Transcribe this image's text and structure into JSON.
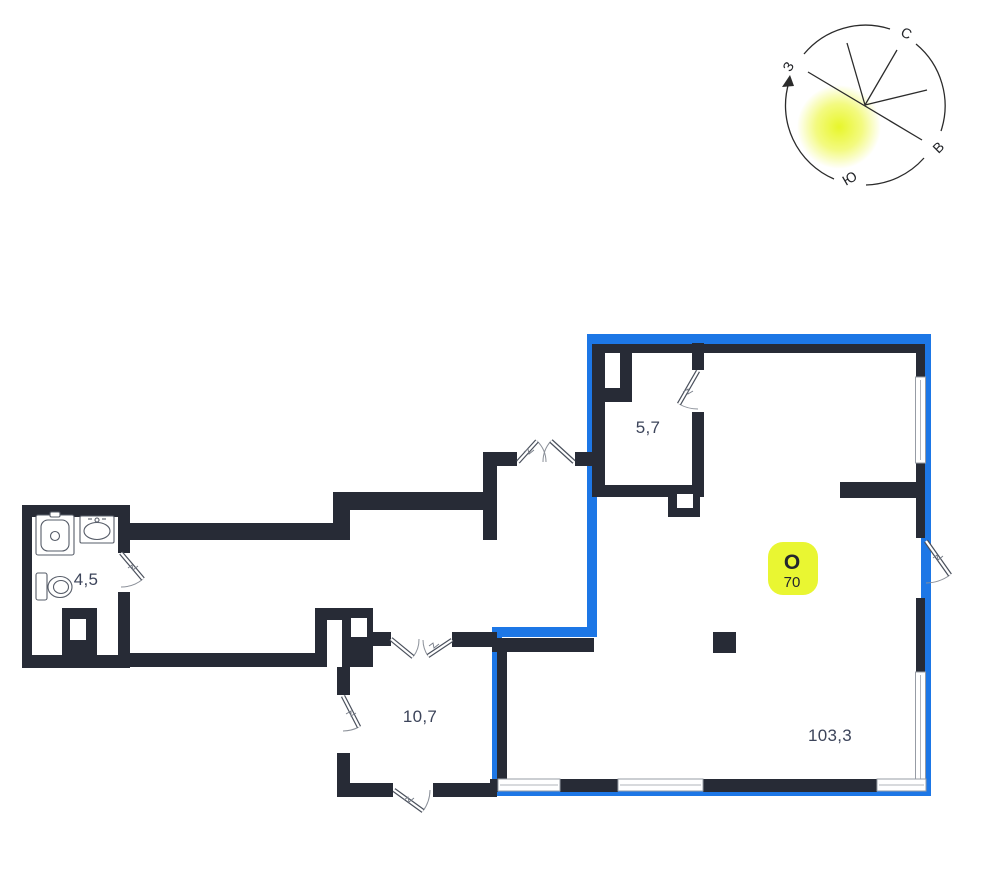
{
  "compass": {
    "north": "С",
    "east": "В",
    "south": "Ю",
    "west": "З"
  },
  "badge": {
    "letter": "О",
    "number": "70"
  },
  "rooms": [
    {
      "id": "bathroom",
      "area_label": "4,5"
    },
    {
      "id": "room-top",
      "area_label": "5,7"
    },
    {
      "id": "hall",
      "area_label": "10,7"
    },
    {
      "id": "main-room",
      "area_label": "103,3"
    }
  ],
  "colors": {
    "wall": "#272b36",
    "highlight": "#1d77e6",
    "label": "#3c445a",
    "badge_bg": "#e9f632",
    "badge_text": "#23262d",
    "glow": "#e6f520",
    "compass_stroke": "#2b2b2b"
  }
}
